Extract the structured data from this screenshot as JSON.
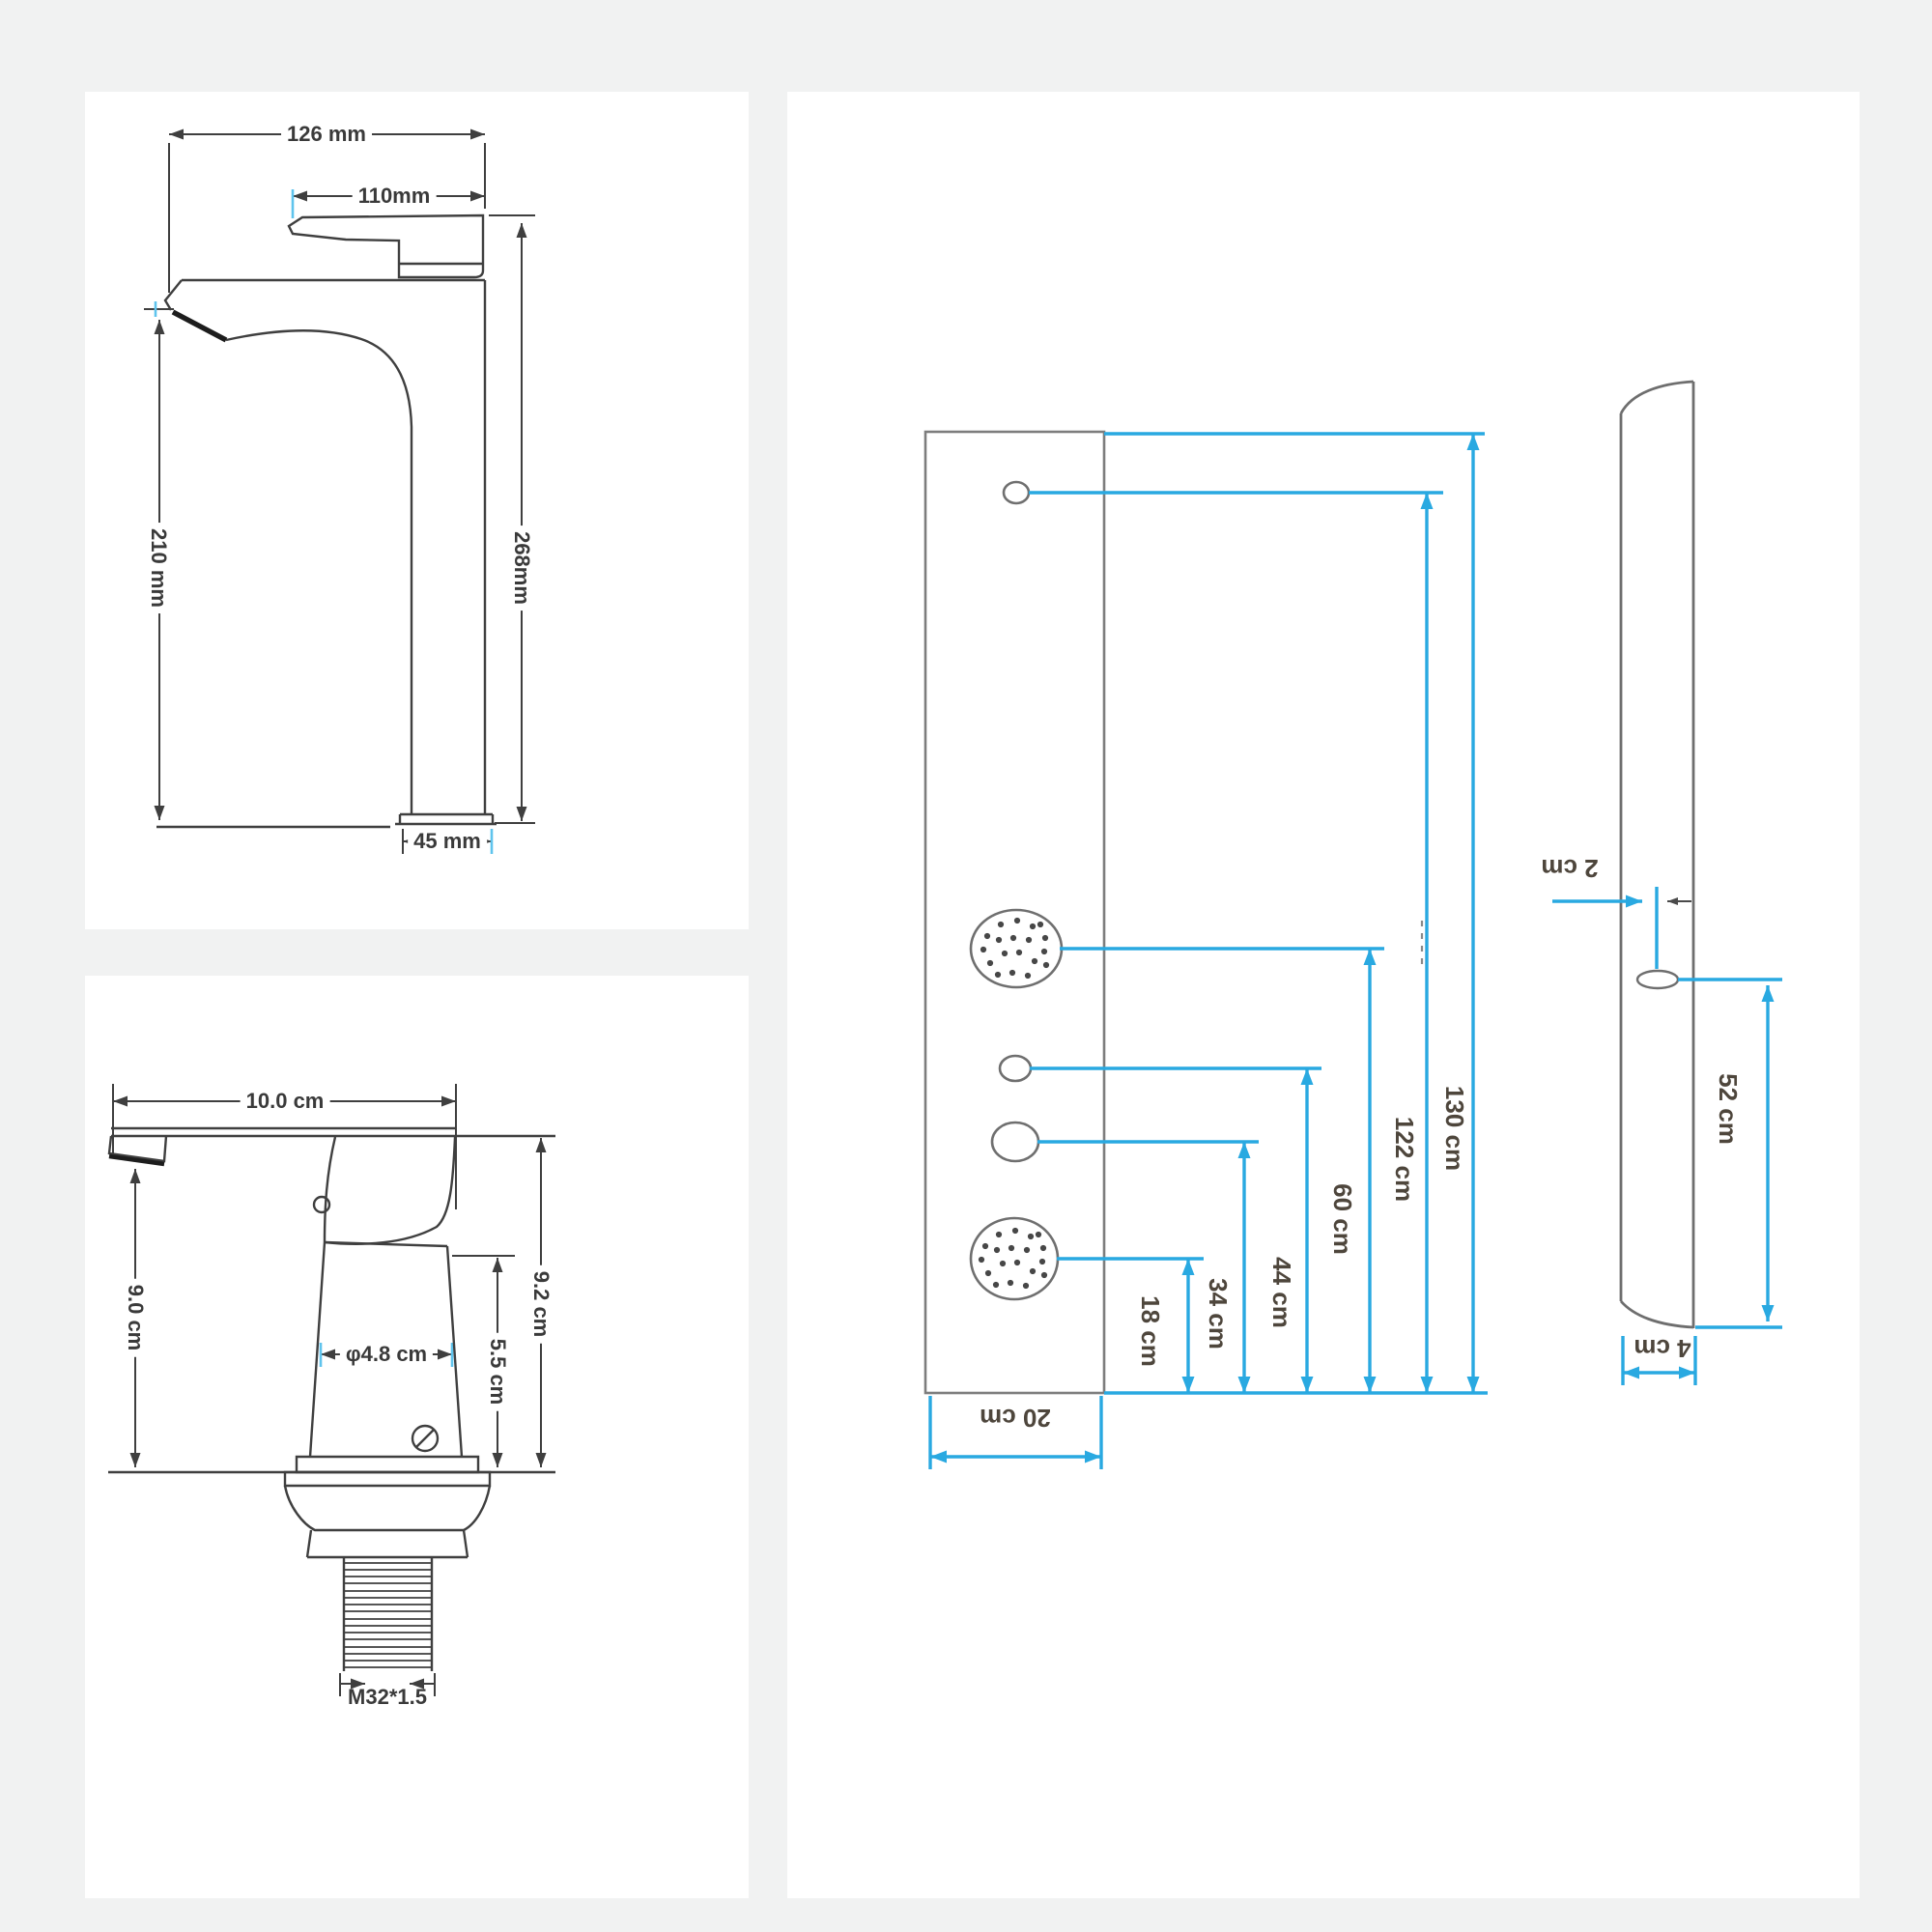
{
  "colors": {
    "accent_blue": "#29a9e1",
    "drawing_line": "#3f3f3f",
    "panel_outline": "#7d7d7d",
    "dim_text_dark": "#3a3a3a",
    "dim_text_brown": "#4e463c",
    "card_background": "#ffffff",
    "page_background": "#f1f2f2"
  },
  "labels": {
    "faucet_tall": {
      "total_width": "126 mm",
      "handle_width": "110mm",
      "total_height": "268mm",
      "spout_height": "210 mm",
      "base_width": "45 mm"
    },
    "faucet_short": {
      "total_width": "10.0 cm",
      "spout_height": "9.0 cm",
      "body_diameter": "φ4.8 cm",
      "body_height": "5.5 cm",
      "total_height": "9.2 cm",
      "thread_spec": "M32*1.5"
    },
    "shower_panel": {
      "total_height": "130 cm",
      "top_hole_height": "122 cm",
      "shower_head_height": "60 cm",
      "mid_hole_height": "44 cm",
      "lower_hole_height": "34 cm",
      "bottom_jet_height": "18 cm",
      "panel_width": "20 cm",
      "hole_edge_offset": "2 cm",
      "panel_depth": "4 cm",
      "side_hole_height": "52 cm"
    }
  }
}
